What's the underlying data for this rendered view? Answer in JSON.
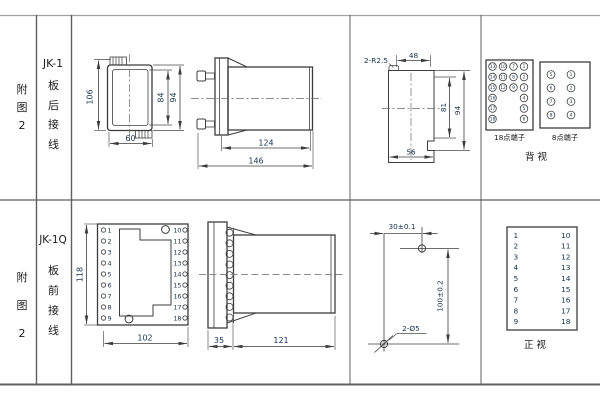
{
  "rows": {
    "r1": {
      "fig": "附\n图\n2",
      "model": "JK-1",
      "wiring": "板\n后\n接\n线"
    },
    "r2": {
      "fig": "附\n图\n2",
      "model": "JK-1Q",
      "wiring": "板\n前\n接\n线"
    }
  },
  "jk1_front": {
    "dim_height_total": "106",
    "dim_height_inner": "84",
    "dim_height_case": "94",
    "dim_width": "60"
  },
  "jk1_side": {
    "dim_body": "124",
    "dim_total": "146"
  },
  "cutout": {
    "radius_label": "2-R2.5",
    "dim_top": "48",
    "dim_right_inner": "81",
    "dim_right_outer": "94",
    "dim_bottom": "56"
  },
  "rear_view": {
    "t18": {
      "caption": "18点端子",
      "rows": [
        [
          13,
          10,
          7,
          1
        ],
        [
          14,
          11,
          8,
          2
        ],
        [
          15,
          12,
          9,
          3
        ],
        [
          16,
          null,
          null,
          4
        ],
        [
          17,
          null,
          null,
          5
        ],
        [
          18,
          null,
          null,
          6
        ]
      ]
    },
    "t8": {
      "caption": "8点端子",
      "rows": [
        [
          5,
          1
        ],
        [
          6,
          2
        ],
        [
          7,
          3
        ],
        [
          8,
          4
        ]
      ]
    },
    "caption": "背  视"
  },
  "jk1q_front": {
    "dim_height": "118",
    "dim_width": "102",
    "left_terminals": [
      1,
      2,
      3,
      4,
      5,
      6,
      7,
      8,
      9
    ],
    "right_terminals": [
      10,
      11,
      12,
      13,
      14,
      15,
      16,
      17,
      18
    ]
  },
  "jk1q_side": {
    "dim_plate": "35",
    "dim_body": "121"
  },
  "drilling": {
    "dim_h": "30±0.1",
    "dim_v": "100±0.2",
    "holes_label": "2-Ø5"
  },
  "front_view_table": {
    "caption": "正  视",
    "left": [
      1,
      2,
      3,
      4,
      5,
      6,
      7,
      8,
      9
    ],
    "right": [
      10,
      11,
      12,
      13,
      14,
      15,
      16,
      17,
      18
    ]
  }
}
